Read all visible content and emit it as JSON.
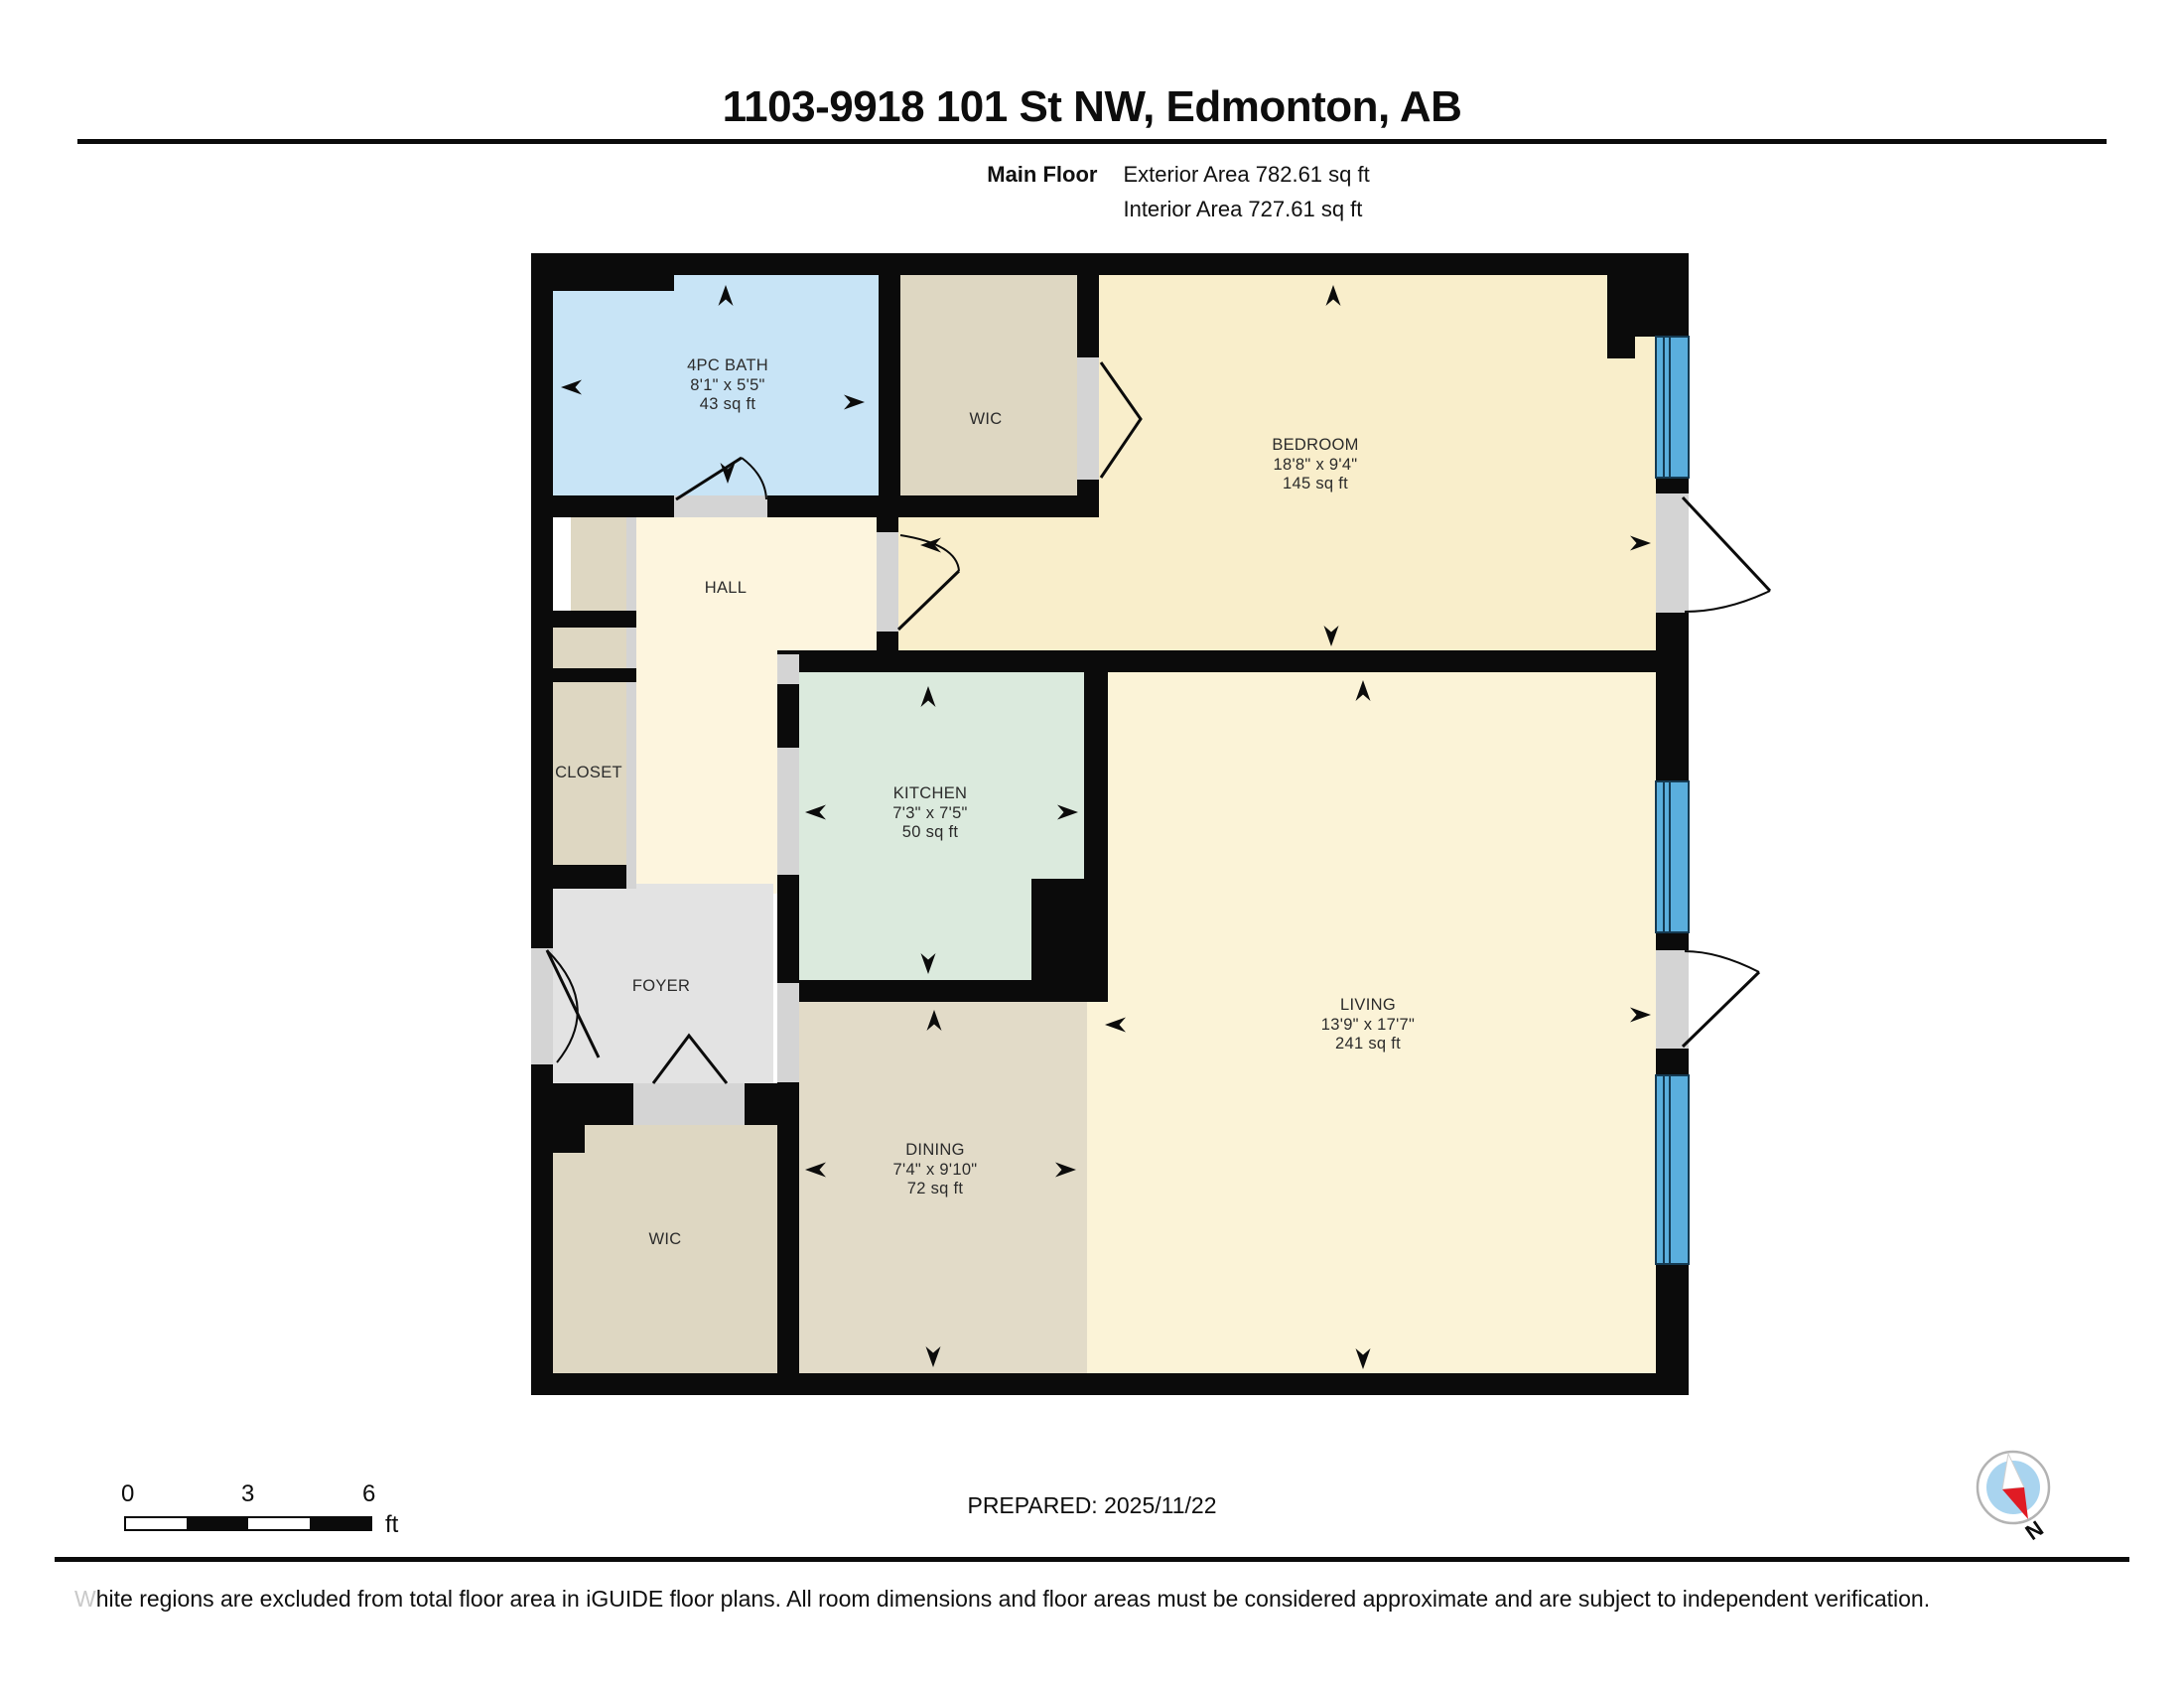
{
  "header": {
    "title": "1103-9918 101 St NW, Edmonton, AB",
    "floor_label": "Main Floor",
    "exterior_area": "Exterior Area 782.61 sq ft",
    "interior_area": "Interior Area 727.61 sq ft"
  },
  "plan": {
    "rooms": {
      "bath": {
        "name": "4PC BATH",
        "dims": "8'1\" x 5'5\"",
        "area": "43 sq ft"
      },
      "wic_upper": {
        "name": "WIC"
      },
      "bedroom": {
        "name": "BEDROOM",
        "dims": "18'8\" x 9'4\"",
        "area": "145 sq ft"
      },
      "hall": {
        "name": "HALL"
      },
      "closet": {
        "name": "CLOSET"
      },
      "kitchen": {
        "name": "KITCHEN",
        "dims": "7'3\" x 7'5\"",
        "area": "50 sq ft"
      },
      "foyer": {
        "name": "FOYER"
      },
      "living": {
        "name": "LIVING",
        "dims": "13'9\" x 17'7\"",
        "area": "241 sq ft"
      },
      "dining": {
        "name": "DINING",
        "dims": "7'4\" x 9'10\"",
        "area": "72 sq ft"
      },
      "wic_lower": {
        "name": "WIC"
      }
    }
  },
  "colors": {
    "wall": "#0b0b0b",
    "bath": "#c8e4f6",
    "closet_wic": "#ded7c2",
    "bedroom": "#f9eecb",
    "hall": "#fdf5de",
    "kitchen": "#dbeadd",
    "foyer": "#e3e3e3",
    "living": "#fbf3d7",
    "dining": "#e2dbc8",
    "window": "#5aaedd",
    "opening": "#d4d4d4",
    "compass_needle_red": "#e01b24",
    "compass_inner": "#a9d4ef"
  },
  "footer": {
    "scale": {
      "ticks": [
        "0",
        "3",
        "6"
      ],
      "unit": "ft"
    },
    "prepared": "PREPARED: 2025/11/22",
    "compass_label": "N",
    "disclaimer": "White regions are excluded from total floor area in iGUIDE floor plans. All room dimensions and floor areas must be considered approximate and are subject to independent verification."
  }
}
